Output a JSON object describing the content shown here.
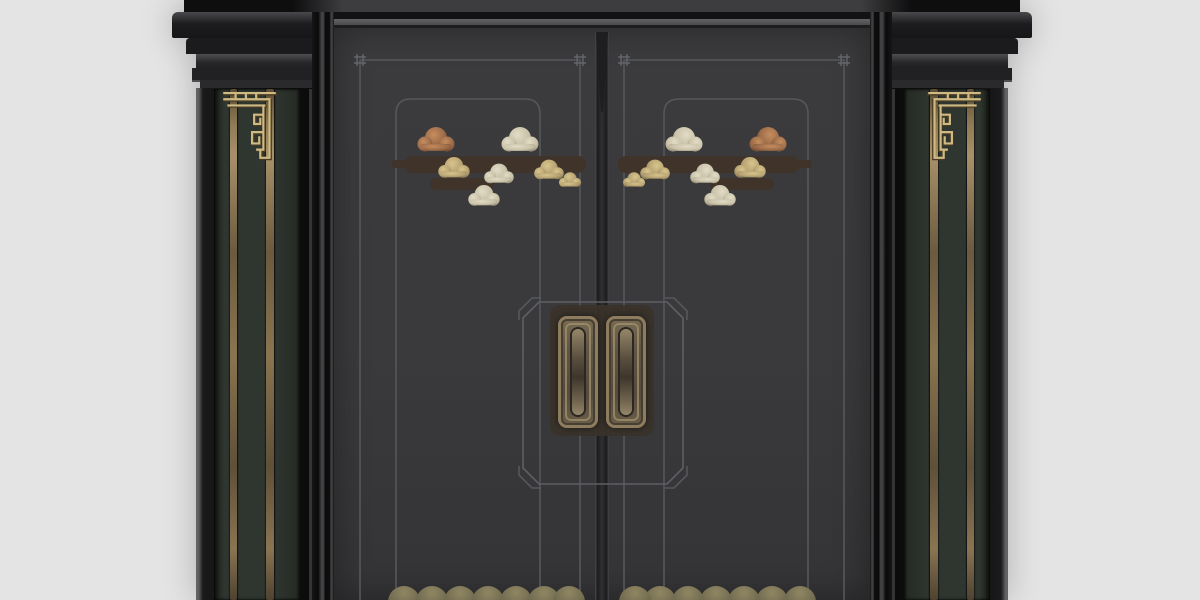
{
  "scene": {
    "subject": "black-and-gold chinese-style double entry door with flanking pilasters",
    "background_color": "#e4e4e4",
    "text_content": "none"
  },
  "components": {
    "pillars": {
      "count": 2,
      "gold_inlay_lines_per_pillar": 2,
      "capital_moldings": 5,
      "fret_ornaments": 2
    },
    "doors": {
      "leaves": 2,
      "outline_frames_per_leaf": 2,
      "corner_marks": 4,
      "cloud_motif_groups": 2,
      "bottom_scallops_per_leaf": 7
    },
    "lock": {
      "plate_shape": "chamfered-rectangle outline",
      "handles": 2
    }
  },
  "colors": {
    "bg": "#e4e4e4",
    "leaf": "#3a3a3c",
    "panelGreen": "#2f3630",
    "goldLine": "#8a7452",
    "goldLineHi": "#a8906a",
    "fretGold": "#cfba82",
    "fretShadow": "#4a3c24",
    "line": "#56575b",
    "lineBright": "#5d5f63",
    "cloudGold": "#b5a272",
    "cloudCopper": "#9a6a48",
    "cloudSilver": "#c9c1a8",
    "cloudDark": "#3f332a",
    "handleBrass": "#8d7c5e",
    "handleSlot": "#948669",
    "scallop": "#8f8662",
    "scallopDark": "#5f5a42",
    "backplate": "#3a332a"
  }
}
